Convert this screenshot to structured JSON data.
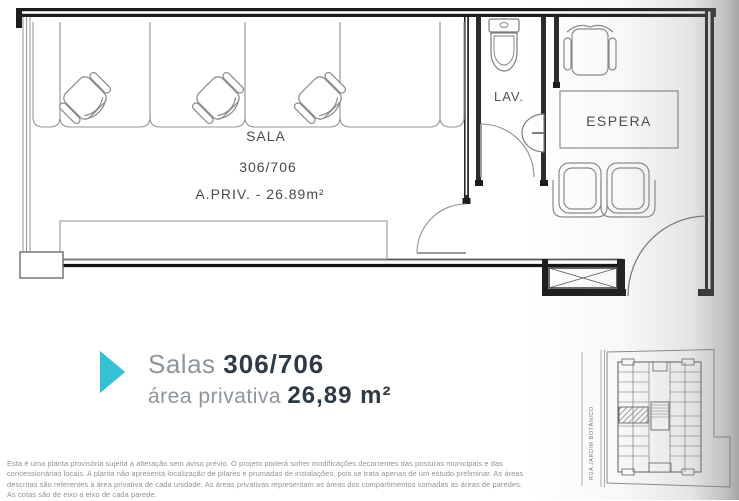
{
  "plan": {
    "sala_label": "SALA",
    "sala_number": "306/706",
    "sala_area": "A.PRIV. - 26.89m²",
    "lav_label": "LAV.",
    "espera_label": "ESPERA"
  },
  "title": {
    "prefix": "Salas",
    "number": "306/706",
    "area_label": "área privativa",
    "area_value": "26,89 m²"
  },
  "keymap": {
    "street_label": "RUA JARDIM BOTÂNICO"
  },
  "disclaimer": {
    "lines": [
      "Esta é uma planta provisória sujeita a alteração sem aviso prévio. O projeto poderá sofrer modificações decorrentes das posturas municipais e das",
      "concessionárias locais. A planta não apresenta localização de pilares e prumadas de instalações, pois se trata apenas de um estudo preliminar. As áreas",
      "descritas são referentes à área privativa de cada unidade. As áreas privativas representam as áreas dos compartimentos somadas as áreas de paredes.",
      "As cotas são de eixo a eixo de cada parede."
    ]
  },
  "colors": {
    "accent_teal": "#35c0d3",
    "heading_dark": "#2f3a44",
    "muted_gray": "#8e959b"
  }
}
